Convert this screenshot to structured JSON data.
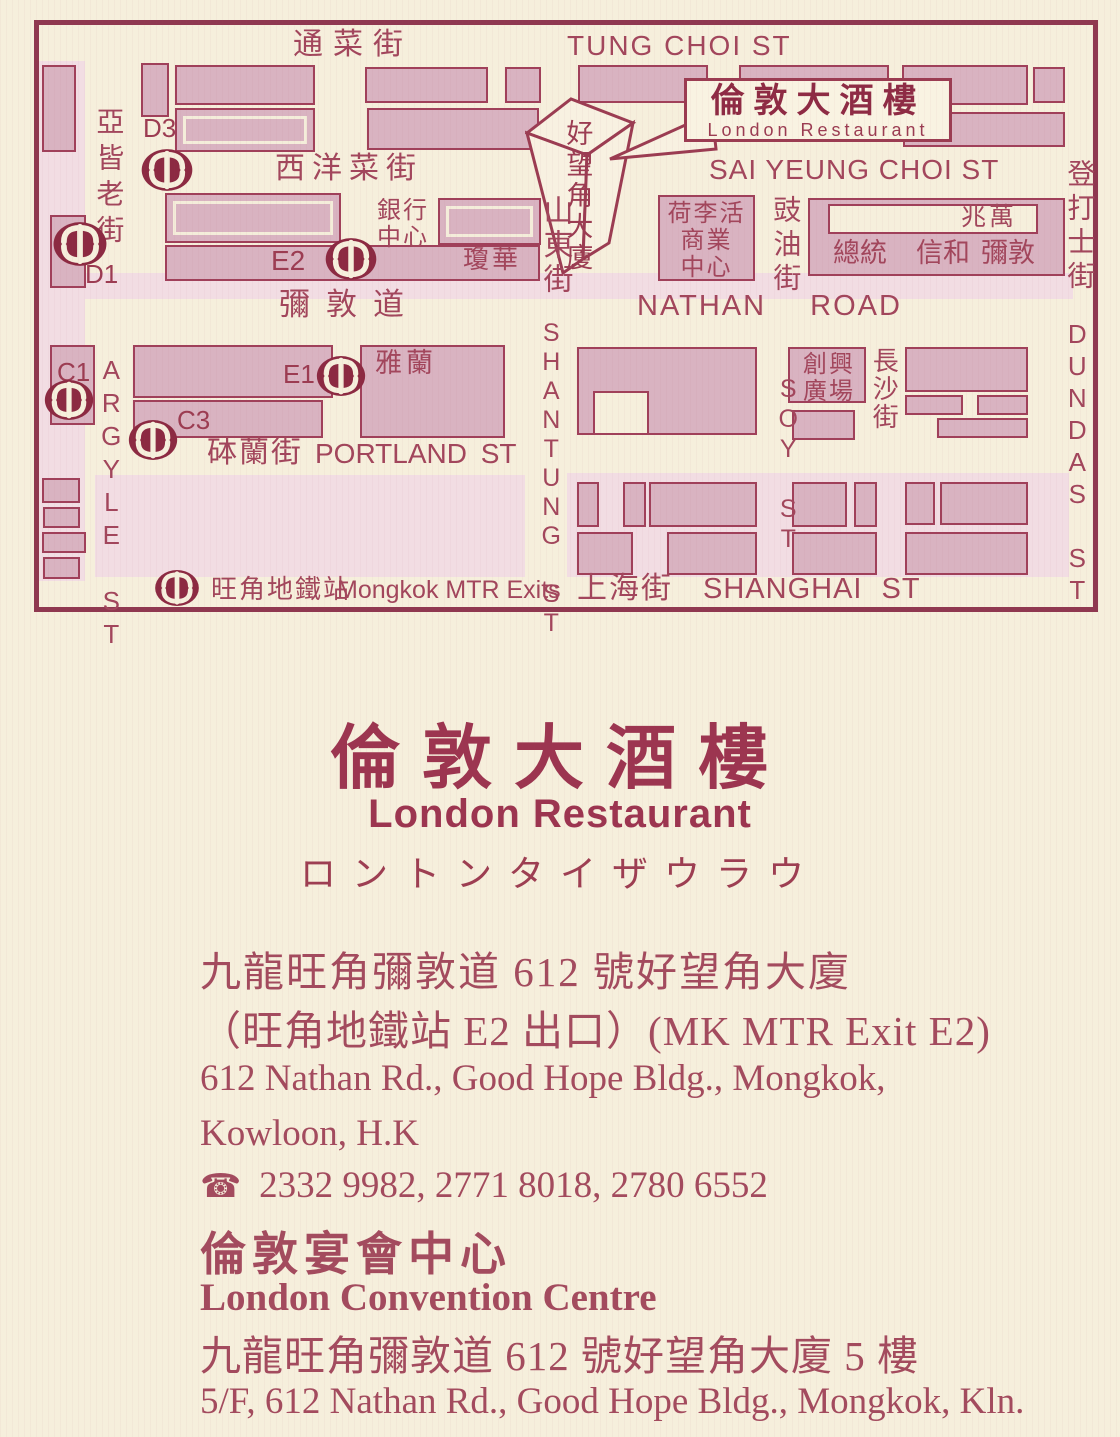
{
  "colors": {
    "paper": "#f6efdc",
    "ink": "#9d3f55",
    "dark_maroon": "#8c2a42",
    "building_fill": "#d9b3c1",
    "road_tint": "#f2dde3"
  },
  "map": {
    "sign": {
      "zh": "倫敦大酒樓",
      "en": "London Restaurant"
    },
    "legend": {
      "zh": "旺角地鐵站",
      "en": "Mongkok MTR Exits"
    },
    "streets": {
      "tung_choi_zh": "通菜街",
      "tung_choi_en": "TUNG CHOI ST",
      "sai_yeung_choi_zh": "西洋菜街",
      "sai_yeung_choi_en": "SAI YEUNG CHOI ST",
      "nathan_zh": "彌敦道",
      "nathan_en": "NATHAN ROAD",
      "portland_zh": "砵蘭街",
      "portland_en": "PORTLAND ST",
      "shanghai_zh": "上海街",
      "shanghai_en": "SHANGHAI ST",
      "argyle_zh": "亞皆老街",
      "argyle_en": "ARGYLE ST",
      "shantung_zh": "山東街",
      "shantung_en": "SHANTUNG ST",
      "soy_zh": "豉油街",
      "soy_en": "SOY ST",
      "cheung_sha_zh": "長沙街",
      "dundas_zh": "登打士街",
      "dundas_en": "DUNDAS ST"
    },
    "buildings": {
      "good_hope": "好望角大廈",
      "bank_centre": [
        "銀行",
        "中心"
      ],
      "king_wah": "瓊華",
      "hollywood": [
        "荷李活",
        "商業",
        "中心"
      ],
      "siu_man": "兆萬",
      "president": "總統",
      "sino": "信和",
      "nathan_bldg": "彌敦",
      "grand_tower": "雅蘭",
      "chong_hing": [
        "創興",
        "廣場"
      ]
    },
    "exits": {
      "d3": "D3",
      "d1": "D1",
      "e2": "E2",
      "e1": "E1",
      "c1": "C1",
      "c3": "C3"
    }
  },
  "card": {
    "title_zh": "倫敦大酒樓",
    "title_en": "London Restaurant",
    "title_kana": "ロントンタイザウラウ",
    "address_zh": "九龍旺角彌敦道 612 號好望角大廈",
    "address_exit": "（旺角地鐵站 E2 出口）(MK MTR Exit E2)",
    "address_en_1": "612 Nathan Rd., Good Hope Bldg., Mongkok,",
    "address_en_2": "Kowloon, H.K",
    "phone_icon": "☎",
    "phones": "2332 9982, 2771 8018, 2780 6552",
    "centre_zh": "倫敦宴會中心",
    "centre_en": "London Convention Centre",
    "centre_address_zh": "九龍旺角彌敦道 612 號好望角大廈 5 樓",
    "centre_address_en": "5/F, 612 Nathan Rd., Good Hope Bldg., Mongkok, Kln."
  }
}
